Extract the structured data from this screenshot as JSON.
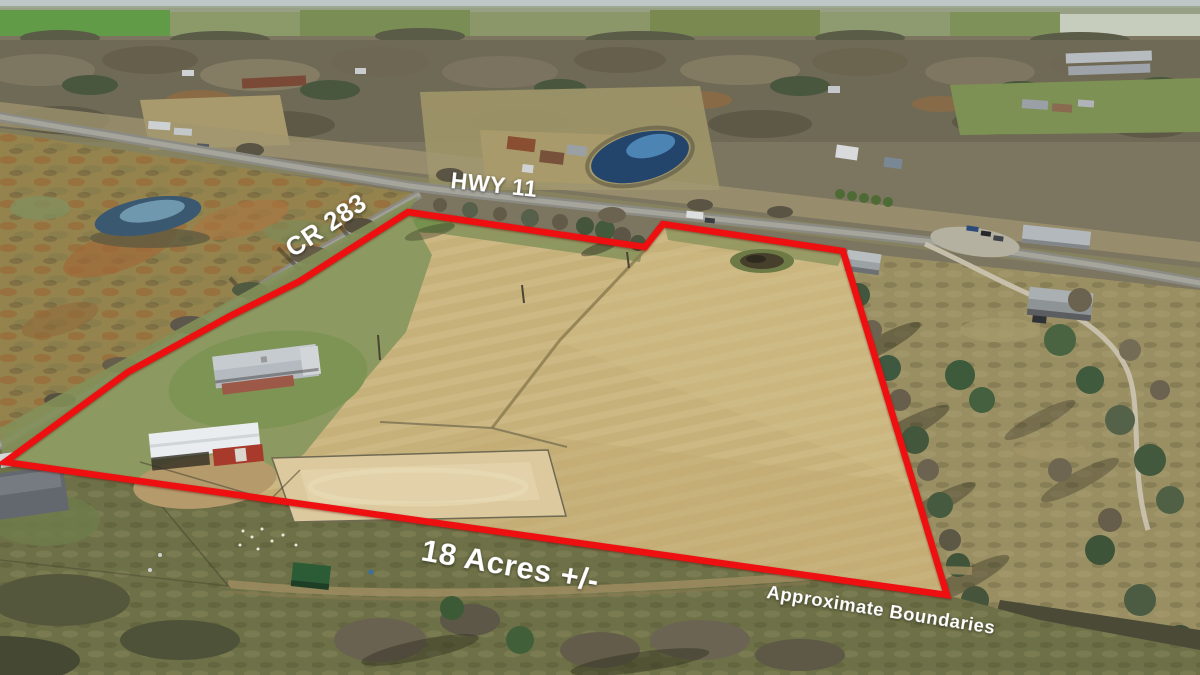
{
  "annotations": {
    "highway_label": "HWY 11",
    "county_road_label": "CR 283",
    "acreage_label": "18 Acres +/-",
    "disclaimer_label": "Approximate Boundaries",
    "boundary_color": "#ee1010",
    "label_color": "#ffffff"
  }
}
